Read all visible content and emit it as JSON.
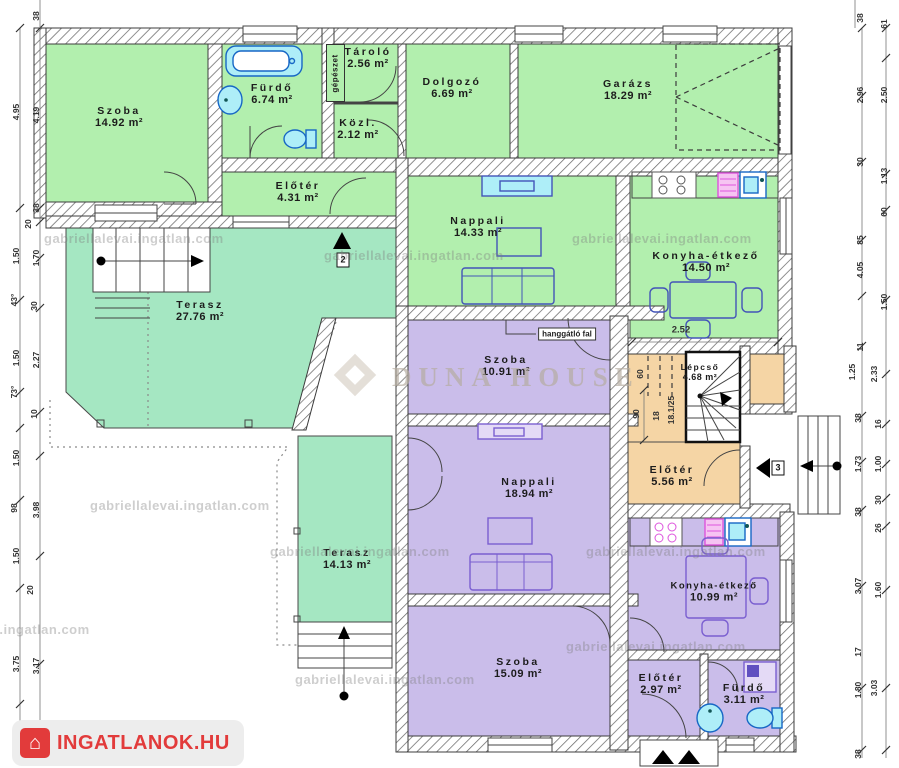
{
  "palette": {
    "green": "#b2efae",
    "teal": "#a5e7c2",
    "purple": "#cabdea",
    "tan": "#f5d5a5",
    "fixture_blue": "#1767c5",
    "fixture_fill": "#aeeef8",
    "furniture_blue": "#4354b8",
    "furniture_purple": "#7a5fd0",
    "pink": "#dd55dd",
    "logo_red": "#e23b3b",
    "brand_gray": "#b5aca0"
  },
  "watermark": {
    "tile": "gabriellalevai.ingatlan.com",
    "brand": "DUNA HOUSE"
  },
  "logo": {
    "text": "INGATLANOK.HU"
  },
  "rooms": [
    {
      "name": "Szoba",
      "area": "14.92 m²"
    },
    {
      "name": "Fürdő",
      "area": "6.74 m²"
    },
    {
      "name": "Tároló",
      "area": "2.56 m²"
    },
    {
      "name": "Közl.",
      "area": "2.12 m²"
    },
    {
      "name": "Dolgozó",
      "area": "6.69 m²"
    },
    {
      "name": "Garázs",
      "area": "18.29 m²"
    },
    {
      "name": "Előtér",
      "area": "4.31 m²"
    },
    {
      "name": "Nappali",
      "area": "14.33 m²"
    },
    {
      "name": "Konyha-étkező",
      "area": "14.50 m²"
    },
    {
      "name": "Terasz",
      "area": "27.76 m²"
    },
    {
      "name": "Szoba",
      "area": "10.91 m²"
    },
    {
      "name": "Lépcső",
      "area": "4.68 m²"
    },
    {
      "name": "Előtér",
      "area": "5.56 m²"
    },
    {
      "name": "Nappali",
      "area": "18.94 m²"
    },
    {
      "name": "Terasz",
      "area": "14.13 m²"
    },
    {
      "name": "Szoba",
      "area": "15.09 m²"
    },
    {
      "name": "Konyha-étkező",
      "area": "10.99 m²"
    },
    {
      "name": "Előtér",
      "area": "2.97 m²"
    },
    {
      "name": "Fürdő",
      "area": "3.11 m²"
    }
  ],
  "labels": {
    "gepeszet": "gépészet",
    "hanggatlo_fal": "hanggátló fal",
    "dim_252": "2.52",
    "dim_90": "90",
    "dim_60": "60",
    "stair_count": "18",
    "stair_ratio": "18.1/25",
    "marker_2": "2",
    "marker_3": "3"
  },
  "dims_left": [
    "38",
    "4.95",
    "4.19",
    "38",
    "20",
    "1.50",
    "1.70",
    "43°",
    "30",
    "1.50",
    "2.27",
    "73°",
    "10",
    "1.50",
    "98",
    "3.98",
    "1.50",
    "20",
    "3.75",
    "3.17",
    "38"
  ],
  "dims_right": [
    "38",
    "61",
    "2.96",
    "2.50",
    "30",
    "1.13",
    "60",
    "85",
    "4.05",
    "1.50",
    "11",
    "1.25",
    "2.33",
    "38",
    "16",
    "1.73",
    "1.00",
    "30",
    "38",
    "26",
    "3.07",
    "1.60",
    "17",
    "1.80",
    "3.03",
    "38"
  ]
}
